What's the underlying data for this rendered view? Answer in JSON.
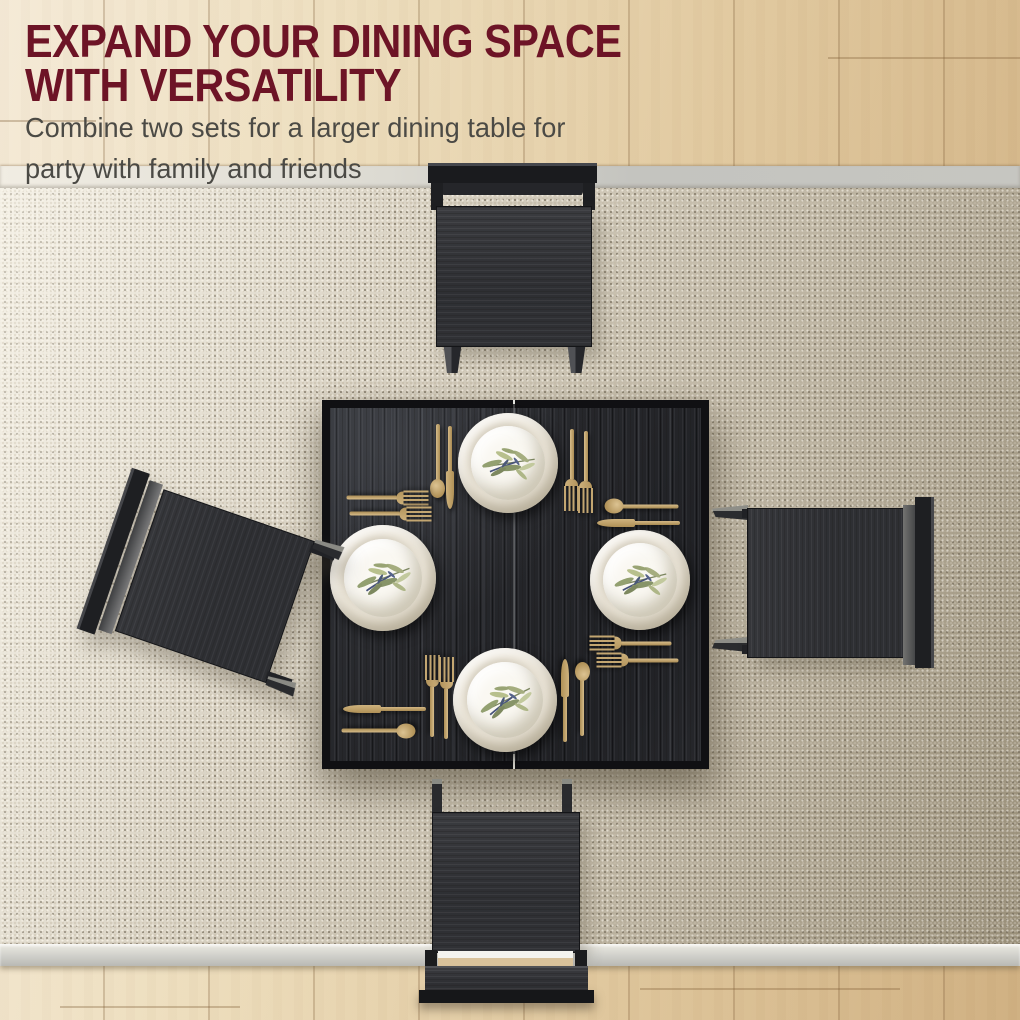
{
  "header": {
    "title_line1": "EXPAND YOUR DINING SPACE",
    "title_line2": "WITH VERSATILITY",
    "subtitle_line1": "Combine two sets for a larger dining table for",
    "subtitle_line2": "party with family and friends"
  },
  "colors": {
    "headline": "#6d1426",
    "subtitle": "#4b4a45",
    "gold": "#c3a671",
    "table_surface": "#26272b",
    "chair_wood": "#2e2f33",
    "plate_cream": "#ebe5d8",
    "rug_light": "#ece7dc",
    "rug_dark": "#aba189",
    "rug_binding": "#c6c6c1",
    "wood_light": "#f7eedd",
    "wood_dark": "#d0b183"
  },
  "scene": {
    "description": "Top-down view of a black square two-piece dining table with four gold place settings on a woven beige rug, surrounded by four black chairs on an oak floor",
    "place_settings": 4,
    "chairs": 4
  }
}
